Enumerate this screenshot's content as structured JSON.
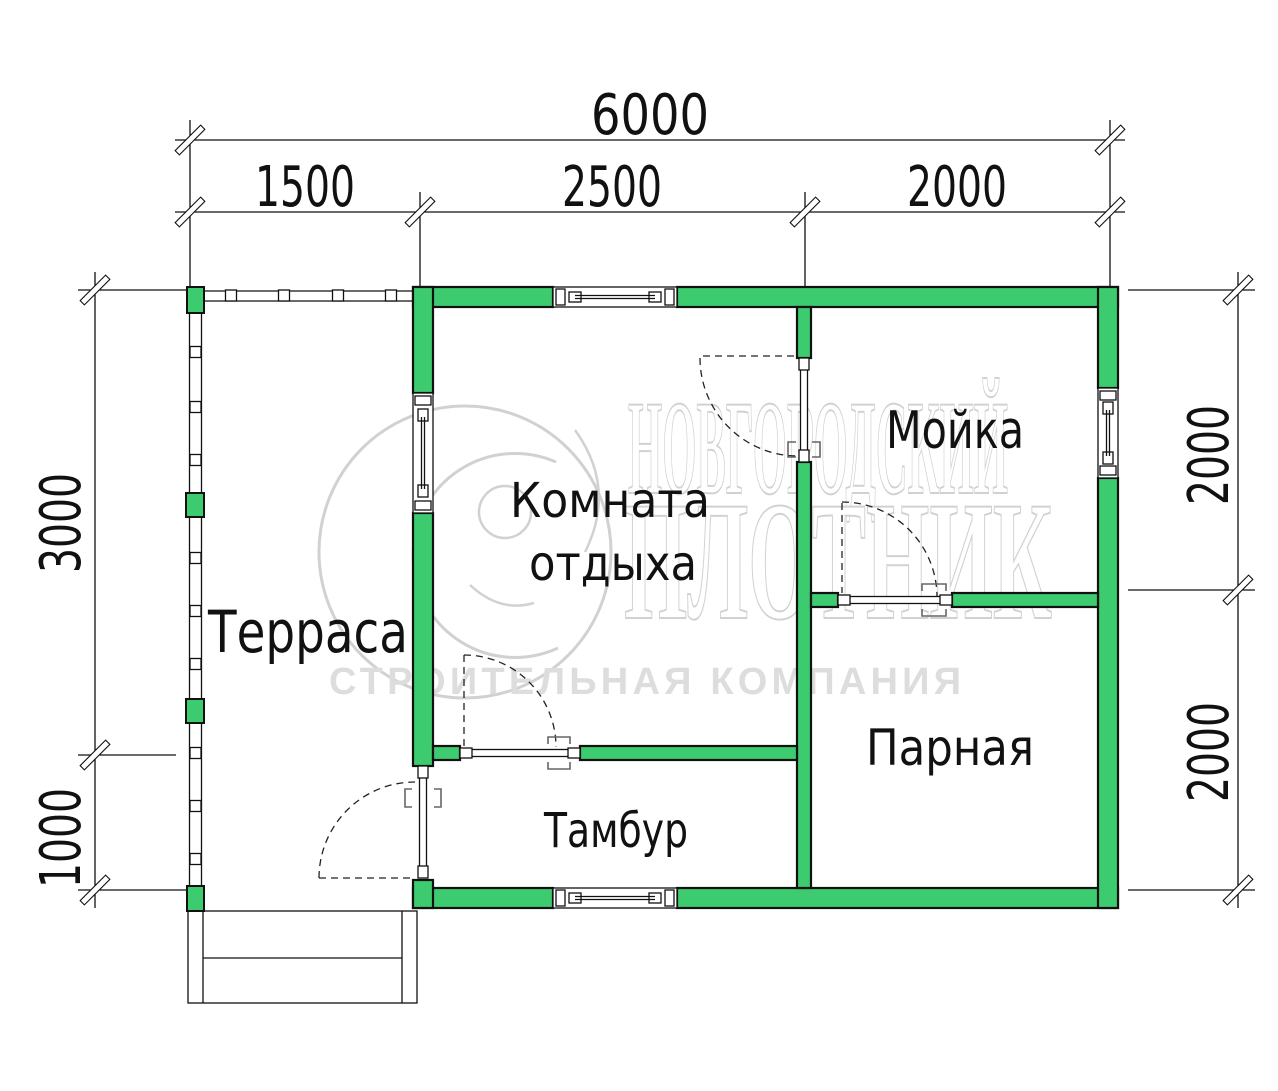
{
  "colors": {
    "wall": "#3ccb6f",
    "line": "#111111",
    "wm": "#cfcfcf",
    "wm2": "#dcdcdc"
  },
  "rooms": {
    "terrace": "Терраса",
    "lounge_line1": "Комната",
    "lounge_line2": "отдыха",
    "washroom": "Мойка",
    "steam_room": "Парная",
    "vestibule": "Тамбур"
  },
  "dimensions": {
    "top_total": "6000",
    "top_seg1": "1500",
    "top_seg2": "2500",
    "top_seg3": "2000",
    "left_main": "3000",
    "left_porch": "1000",
    "right_top": "2000",
    "right_bottom": "2000"
  },
  "watermark": {
    "word1": "НОВГОРОДСКИЙ",
    "word2": "ПЛОТНИК",
    "tagline": "СТРОИТЕЛЬНАЯ КОМПАНИЯ"
  }
}
